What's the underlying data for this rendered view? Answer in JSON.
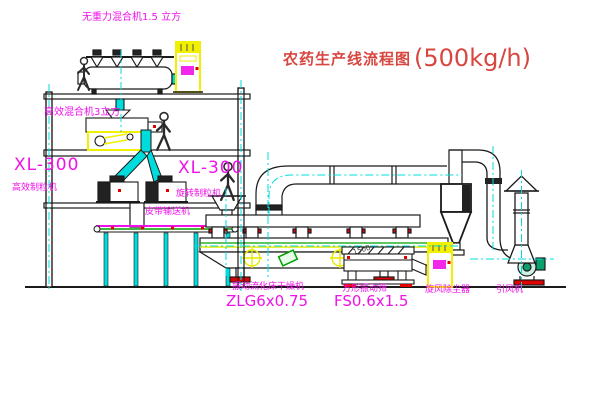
{
  "title": {
    "text": "农药生产线流程图",
    "capacity": "(500kg/h)"
  },
  "equipment_labels": {
    "gravity_mixer": "无重力混合机1.5 立方",
    "high_efficiency_mixer": "高效混合机3立方",
    "granulator_left": {
      "model": "XL-300",
      "name": "高效制粒机"
    },
    "granulator_right": {
      "model": "XL-300",
      "name": "旋转制粒机"
    },
    "belt_conveyor": "皮带输送机",
    "fluid_bed_dryer": {
      "name": "振动流化床干燥机",
      "model": "ZLG6x0.75"
    },
    "square_vibrating_screen": {
      "name": "方形振动筛",
      "model": "FS0.6x1.5"
    },
    "cyclone_dust_collector": "旋风除尘器",
    "induced_draft_fan": "引风机",
    "dimension_note": "1500"
  },
  "colors": {
    "title_red": "#d84640",
    "label_magenta": "#f010e8",
    "pipe_cyan": "#00dcdc",
    "highlight_yellow": "#f0f000",
    "machine_green": "#00a000",
    "accent_red": "#e00000",
    "drawing_black": "#1a1a1a"
  }
}
